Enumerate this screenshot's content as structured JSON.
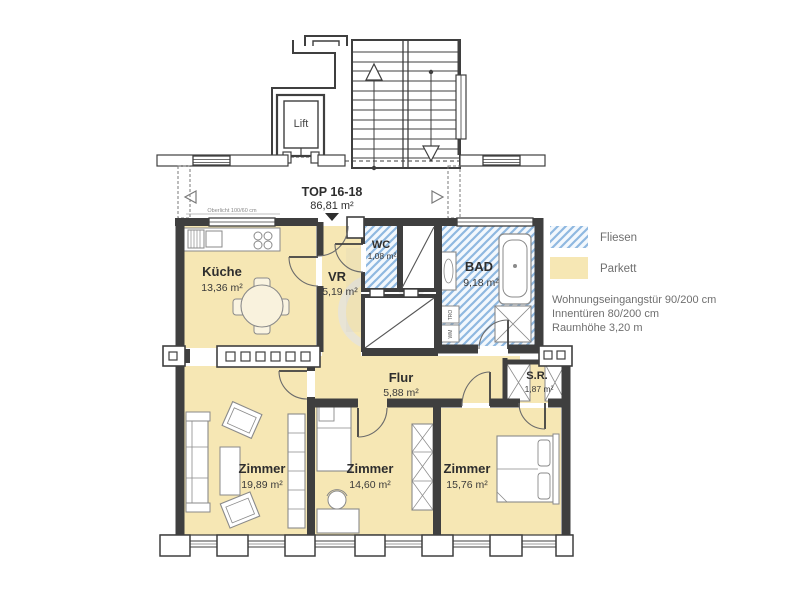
{
  "header": {
    "top_label": "TOP 16-18",
    "top_area": "86,81 m²"
  },
  "stairwell": {
    "lift_label": "Lift"
  },
  "rooms": [
    {
      "id": "kueche",
      "name": "Küche",
      "area": "13,36 m²",
      "floor": "parquet"
    },
    {
      "id": "vr",
      "name": "VR",
      "area": "5,19 m²",
      "floor": "parquet"
    },
    {
      "id": "wc",
      "name": "WC",
      "area": "1,08 m²",
      "floor": "tiles"
    },
    {
      "id": "bad",
      "name": "BAD",
      "area": "9,18 m²",
      "floor": "tiles"
    },
    {
      "id": "flur",
      "name": "Flur",
      "area": "5,88 m²",
      "floor": "parquet"
    },
    {
      "id": "sr",
      "name": "S.R.",
      "area": "1,87 m²",
      "floor": "parquet"
    },
    {
      "id": "zimmer1",
      "name": "Zimmer",
      "area": "19,89 m²",
      "floor": "parquet"
    },
    {
      "id": "zimmer2",
      "name": "Zimmer",
      "area": "14,60 m²",
      "floor": "parquet"
    },
    {
      "id": "zimmer3",
      "name": "Zimmer",
      "area": "15,76 m²",
      "floor": "parquet"
    }
  ],
  "appliances": {
    "wm": "WM",
    "tro": "TRO"
  },
  "annotations": {
    "oberlicht": "Oberlicht 100/60 cm"
  },
  "legend": {
    "items": [
      {
        "label": "Fliesen",
        "swatch": "tiles-hatch"
      },
      {
        "label": "Parkett",
        "swatch": "parquet"
      }
    ],
    "notes": [
      "Wohnungseingangstür 90/200 cm",
      "Innentüren 80/200 cm",
      "Raumhöhe 3,20 m"
    ]
  },
  "colors": {
    "parquet": "#f6e7b4",
    "tile_stripe": "#8fb8e0",
    "tile_bg": "#f3f8fd",
    "wall": "#3f3f3f",
    "furniture_stroke": "#8a8a8a",
    "muted_text": "#6f6f6f"
  }
}
